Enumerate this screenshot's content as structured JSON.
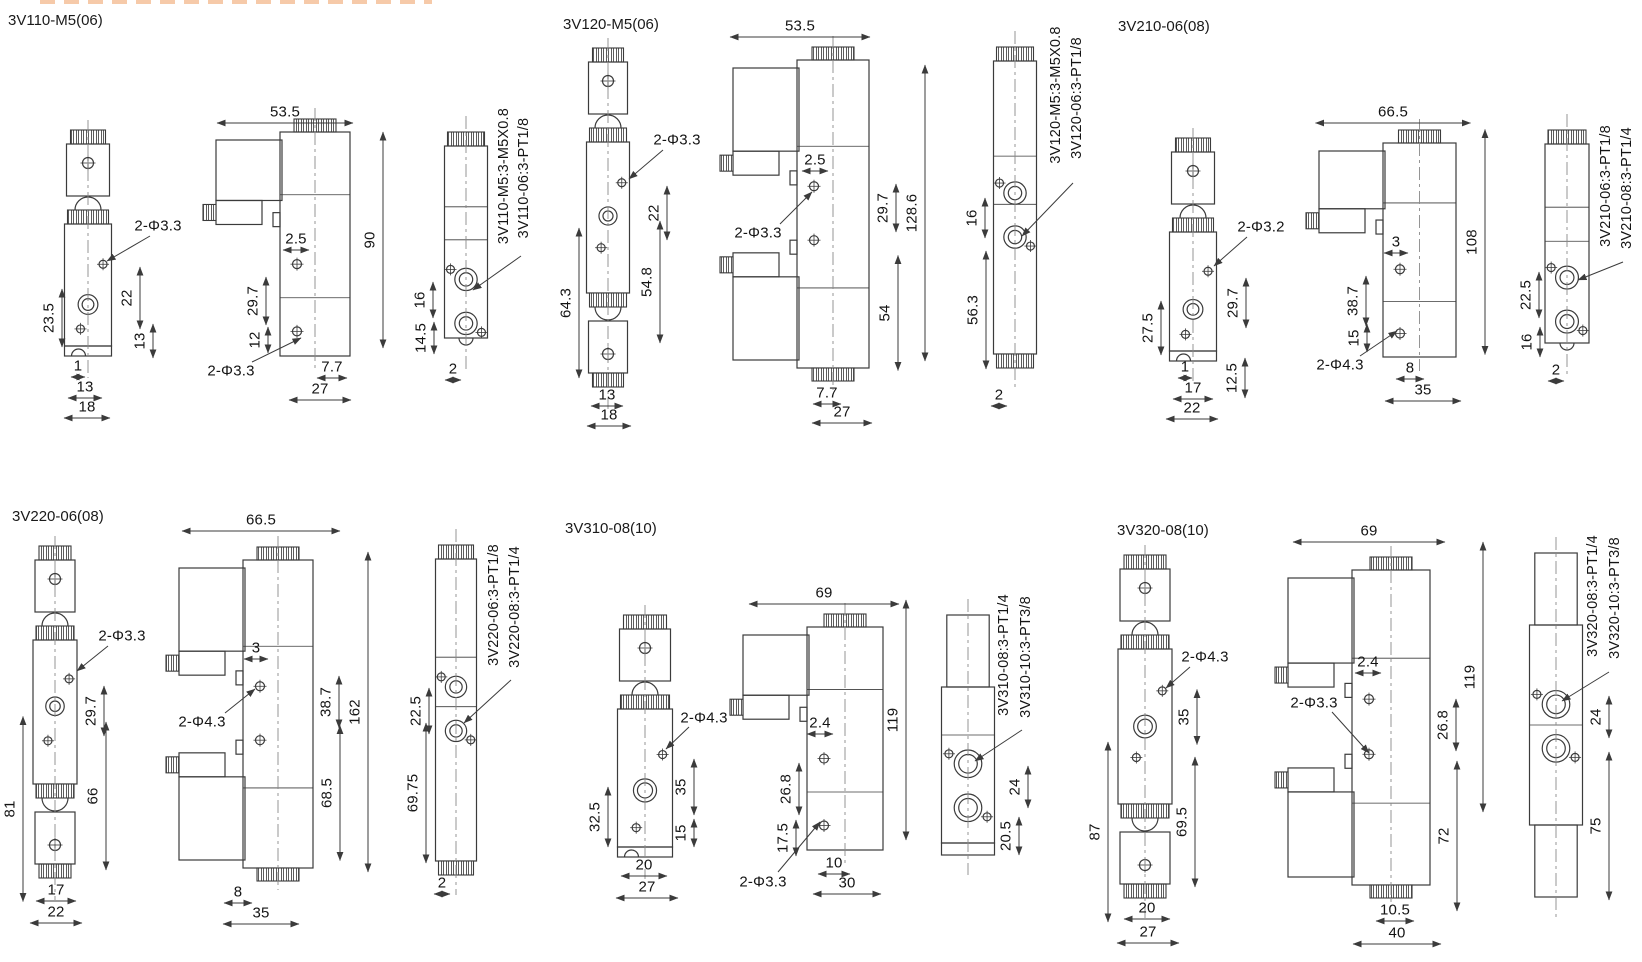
{
  "canvas": {
    "width": 1642,
    "height": 962,
    "background": "#ffffff",
    "line_color": "#3b3b3b",
    "text_color": "#141414"
  },
  "groups": [
    {
      "title": "3V110-M5(06)",
      "views": [
        {
          "kind": "front",
          "cx": 88,
          "top": 130,
          "bottom": 356,
          "bw": 47,
          "pf": 0.66
        },
        {
          "kind": "side",
          "x": 280,
          "top": 132,
          "bottom": 356,
          "bw": 70
        },
        {
          "kind": "end",
          "cx": 466,
          "top": 132,
          "bottom": 352,
          "bw": 43,
          "style": "knurl",
          "pf": 0.67
        }
      ],
      "labels": [
        {
          "t": "2-Φ3.3",
          "x": 158,
          "y": 226,
          "ls": [
            150,
            236
          ],
          "ldr": [
            107,
            261
          ]
        },
        {
          "t": "22",
          "x": 127,
          "y": 298,
          "r": 1,
          "span": 62
        },
        {
          "t": "13",
          "x": 140,
          "y": 341,
          "r": 1,
          "span": 34
        },
        {
          "t": "23.5",
          "x": 49,
          "y": 318,
          "r": 1,
          "span": 58
        },
        {
          "t": "1",
          "x": 78,
          "y": 366,
          "span": 14
        },
        {
          "t": "13",
          "x": 85,
          "y": 387,
          "span": 34
        },
        {
          "t": "18",
          "x": 87,
          "y": 407,
          "span": 46
        },
        {
          "t": "53.5",
          "x": 285,
          "y": 112,
          "span": 136
        },
        {
          "t": "90",
          "x": 370,
          "y": 240,
          "r": 1,
          "span": 216
        },
        {
          "t": "2.5",
          "x": 296,
          "y": 239,
          "span": 26
        },
        {
          "t": "29.7",
          "x": 253,
          "y": 301,
          "r": 1,
          "span": 48
        },
        {
          "t": "12",
          "x": 255,
          "y": 340,
          "r": 1,
          "span": 26
        },
        {
          "t": "2-Φ3.3",
          "x": 231,
          "y": 371,
          "ls": [
            252,
            362
          ],
          "ldr": [
            301,
            338
          ]
        },
        {
          "t": "7.7",
          "x": 332,
          "y": 367,
          "span": 30
        },
        {
          "t": "27",
          "x": 320,
          "y": 389,
          "span": 62
        },
        {
          "t": "3V110-M5:3-M5X0.8",
          "x": 504,
          "y": 176,
          "r": 1,
          "part": 1
        },
        {
          "t": "3V110-06:3-PT1/8",
          "x": 524,
          "y": 178,
          "r": 1,
          "part": 1,
          "ls": [
            521,
            256
          ],
          "ldr": [
            473,
            290
          ]
        },
        {
          "t": "16",
          "x": 420,
          "y": 300,
          "r": 1,
          "span": 36
        },
        {
          "t": "14.5",
          "x": 421,
          "y": 338,
          "r": 1,
          "span": 32
        },
        {
          "t": "2",
          "x": 453,
          "y": 369,
          "span": 16
        }
      ]
    },
    {
      "title": "3V120-M5(06)",
      "views": [
        {
          "kind": "front",
          "cx": 608,
          "top": 48,
          "bottom": 387,
          "bw": 43,
          "double": 1,
          "pf": 0.49
        },
        {
          "kind": "side",
          "x": 797,
          "top": 60,
          "bottom": 368,
          "bw": 72,
          "double": 1
        },
        {
          "kind": "end",
          "cx": 1015,
          "top": 47,
          "bottom": 368,
          "bw": 43,
          "style": "knurl",
          "double": 1,
          "pf": 0.455
        }
      ],
      "labels": [
        {
          "t": "2-Φ3.3",
          "x": 677,
          "y": 140,
          "ls": [
            663,
            150
          ],
          "ldr": [
            629,
            179
          ]
        },
        {
          "t": "22",
          "x": 654,
          "y": 213,
          "r": 1,
          "span": 54
        },
        {
          "t": "64.3",
          "x": 566,
          "y": 303,
          "r": 1,
          "span": 150
        },
        {
          "t": "54.8",
          "x": 647,
          "y": 282,
          "r": 1,
          "span": 122
        },
        {
          "t": "13",
          "x": 607,
          "y": 395,
          "span": 32
        },
        {
          "t": "18",
          "x": 609,
          "y": 415,
          "span": 44
        },
        {
          "t": "53.5",
          "x": 800,
          "y": 26,
          "span": 140
        },
        {
          "t": "2.5",
          "x": 815,
          "y": 160,
          "span": 26
        },
        {
          "t": "2-Φ3.3",
          "x": 758,
          "y": 233,
          "ls": [
            780,
            224
          ],
          "ldr": [
            812,
            192
          ]
        },
        {
          "t": "29.7",
          "x": 883,
          "y": 208,
          "r": 1,
          "span": 48
        },
        {
          "t": "128.6",
          "x": 912,
          "y": 213,
          "r": 1,
          "span": 296
        },
        {
          "t": "54",
          "x": 885,
          "y": 313,
          "r": 1,
          "span": 115
        },
        {
          "t": "7.7",
          "x": 827,
          "y": 393,
          "span": 28
        },
        {
          "t": "27",
          "x": 842,
          "y": 412,
          "span": 60
        },
        {
          "t": "16",
          "x": 972,
          "y": 218,
          "r": 1,
          "span": 40
        },
        {
          "t": "56.3",
          "x": 973,
          "y": 310,
          "r": 1,
          "span": 118
        },
        {
          "t": "2",
          "x": 999,
          "y": 395,
          "span": 16
        },
        {
          "t": "3V120-M5:3-M5X0.8",
          "x": 1056,
          "y": 95,
          "r": 1,
          "part": 1
        },
        {
          "t": "3V120-06:3-PT1/8",
          "x": 1077,
          "y": 98,
          "r": 1,
          "part": 1,
          "ls": [
            1073,
            183
          ],
          "ldr": [
            1022,
            236
          ]
        }
      ]
    },
    {
      "title": "3V210-06(08)",
      "views": [
        {
          "kind": "front",
          "cx": 1193,
          "top": 138,
          "bottom": 361,
          "bw": 47,
          "pf": 0.65
        },
        {
          "kind": "side",
          "x": 1383,
          "top": 143,
          "bottom": 357,
          "bw": 73
        },
        {
          "kind": "end",
          "cx": 1567,
          "top": 130,
          "bottom": 357,
          "bw": 44,
          "style": "knurl",
          "pf": 0.65
        }
      ],
      "labels": [
        {
          "t": "2-Φ3.2",
          "x": 1261,
          "y": 227,
          "ls": [
            1247,
            237
          ],
          "ldr": [
            1214,
            266
          ]
        },
        {
          "t": "29.7",
          "x": 1233,
          "y": 303,
          "r": 1,
          "span": 50
        },
        {
          "t": "12.5",
          "x": 1232,
          "y": 378,
          "r": 1,
          "span": 40
        },
        {
          "t": "27.5",
          "x": 1148,
          "y": 328,
          "r": 1,
          "span": 54
        },
        {
          "t": "1",
          "x": 1185,
          "y": 367,
          "span": 14
        },
        {
          "t": "17",
          "x": 1193,
          "y": 388,
          "span": 40
        },
        {
          "t": "22",
          "x": 1192,
          "y": 408,
          "span": 52
        },
        {
          "t": "66.5",
          "x": 1393,
          "y": 112,
          "span": 155
        },
        {
          "t": "108",
          "x": 1472,
          "y": 242,
          "r": 1,
          "span": 225
        },
        {
          "t": "3",
          "x": 1396,
          "y": 242,
          "span": 24
        },
        {
          "t": "38.7",
          "x": 1353,
          "y": 301,
          "r": 1,
          "span": 50
        },
        {
          "t": "15",
          "x": 1354,
          "y": 338,
          "r": 1,
          "span": 28
        },
        {
          "t": "2-Φ4.3",
          "x": 1340,
          "y": 365,
          "ls": [
            1360,
            356
          ],
          "ldr": [
            1397,
            331
          ]
        },
        {
          "t": "8",
          "x": 1410,
          "y": 368,
          "span": 28
        },
        {
          "t": "35",
          "x": 1423,
          "y": 390,
          "span": 76
        },
        {
          "t": "22.5",
          "x": 1526,
          "y": 295,
          "r": 1,
          "span": 46
        },
        {
          "t": "16",
          "x": 1527,
          "y": 342,
          "r": 1,
          "span": 30
        },
        {
          "t": "2",
          "x": 1556,
          "y": 370,
          "span": 16
        },
        {
          "t": "3V210-06:3-PT1/8",
          "x": 1606,
          "y": 186,
          "r": 1,
          "part": 1
        },
        {
          "t": "3V210-08:3-PT1/4",
          "x": 1627,
          "y": 188,
          "r": 1,
          "part": 1,
          "ls": [
            1623,
            262
          ],
          "ldr": [
            1578,
            280
          ]
        }
      ]
    },
    {
      "title": "3V220-06(08)",
      "views": [
        {
          "kind": "front",
          "cx": 55,
          "top": 546,
          "bottom": 878,
          "bw": 44,
          "double": 1,
          "pf": 0.46
        },
        {
          "kind": "side",
          "x": 243,
          "top": 560,
          "bottom": 868,
          "bw": 70,
          "double": 1
        },
        {
          "kind": "end",
          "cx": 456,
          "top": 545,
          "bottom": 875,
          "bw": 41,
          "style": "knurl",
          "double": 1,
          "pf": 0.43
        }
      ],
      "labels": [
        {
          "t": "2-Φ3.3",
          "x": 122,
          "y": 636,
          "ls": [
            108,
            646
          ],
          "ldr": [
            77,
            671
          ]
        },
        {
          "t": "29.7",
          "x": 91,
          "y": 711,
          "r": 1,
          "span": 50
        },
        {
          "t": "66",
          "x": 93,
          "y": 796,
          "r": 1,
          "span": 148
        },
        {
          "t": "81",
          "x": 10,
          "y": 809,
          "r": 1,
          "span": 185
        },
        {
          "t": "17",
          "x": 56,
          "y": 890,
          "span": 40
        },
        {
          "t": "22",
          "x": 56,
          "y": 912,
          "span": 52
        },
        {
          "t": "66.5",
          "x": 261,
          "y": 520,
          "span": 158
        },
        {
          "t": "3",
          "x": 256,
          "y": 648,
          "span": 24
        },
        {
          "t": "2-Φ4.3",
          "x": 202,
          "y": 722,
          "ls": [
            225,
            713
          ],
          "ldr": [
            255,
            689
          ]
        },
        {
          "t": "38.7",
          "x": 326,
          "y": 702,
          "r": 1,
          "span": 52
        },
        {
          "t": "68.5",
          "x": 327,
          "y": 793,
          "r": 1,
          "span": 135
        },
        {
          "t": "162",
          "x": 355,
          "y": 712,
          "r": 1,
          "span": 320
        },
        {
          "t": "8",
          "x": 238,
          "y": 892,
          "span": 28
        },
        {
          "t": "35",
          "x": 261,
          "y": 913,
          "span": 76
        },
        {
          "t": "22.5",
          "x": 416,
          "y": 711,
          "r": 1,
          "span": 46
        },
        {
          "t": "69.75",
          "x": 413,
          "y": 793,
          "r": 1,
          "span": 140
        },
        {
          "t": "2",
          "x": 442,
          "y": 883,
          "span": 16
        },
        {
          "t": "3V220-06:3-PT1/8",
          "x": 494,
          "y": 605,
          "r": 1,
          "part": 1
        },
        {
          "t": "3V220-08:3-PT1/4",
          "x": 515,
          "y": 607,
          "r": 1,
          "part": 1,
          "ls": [
            511,
            680
          ],
          "ldr": [
            464,
            723
          ]
        }
      ]
    },
    {
      "title": "3V310-08(10)",
      "views": [
        {
          "kind": "front",
          "cx": 645,
          "top": 615,
          "bottom": 857,
          "bw": 55,
          "pf": 0.59
        },
        {
          "kind": "side",
          "x": 807,
          "top": 627,
          "bottom": 850,
          "bw": 76
        },
        {
          "kind": "end",
          "cx": 968,
          "top": 615,
          "bottom": 855,
          "bw": 53,
          "style": "plain",
          "pf": 0.62
        }
      ],
      "labels": [
        {
          "t": "2-Φ4.3",
          "x": 704,
          "y": 718,
          "ls": [
            689,
            727
          ],
          "ldr": [
            666,
            749
          ]
        },
        {
          "t": "35",
          "x": 681,
          "y": 787,
          "r": 1,
          "span": 56
        },
        {
          "t": "15",
          "x": 681,
          "y": 833,
          "r": 1,
          "span": 28
        },
        {
          "t": "32.5",
          "x": 595,
          "y": 817,
          "r": 1,
          "span": 60
        },
        {
          "t": "20",
          "x": 644,
          "y": 865,
          "span": 46
        },
        {
          "t": "27",
          "x": 647,
          "y": 887,
          "span": 62
        },
        {
          "t": "69",
          "x": 824,
          "y": 593,
          "span": 150
        },
        {
          "t": "2.4",
          "x": 820,
          "y": 723,
          "span": 26
        },
        {
          "t": "26.8",
          "x": 786,
          "y": 789,
          "r": 1,
          "span": 52
        },
        {
          "t": "17.5",
          "x": 783,
          "y": 838,
          "r": 1,
          "span": 36
        },
        {
          "t": "119",
          "x": 893,
          "y": 720,
          "r": 1,
          "span": 240
        },
        {
          "t": "10",
          "x": 834,
          "y": 863,
          "span": 32
        },
        {
          "t": "30",
          "x": 847,
          "y": 883,
          "span": 68
        },
        {
          "t": "2-Φ3.3",
          "x": 763,
          "y": 882,
          "ls": [
            778,
            872
          ],
          "ldr": [
            820,
            822
          ]
        },
        {
          "t": "24",
          "x": 1015,
          "y": 787,
          "r": 1,
          "span": 42
        },
        {
          "t": "20.5",
          "x": 1006,
          "y": 836,
          "r": 1,
          "span": 38
        },
        {
          "t": "3V310-08:3-PT1/4",
          "x": 1004,
          "y": 655,
          "r": 1,
          "part": 1
        },
        {
          "t": "3V310-10:3-PT3/8",
          "x": 1026,
          "y": 657,
          "r": 1,
          "part": 1,
          "ls": [
            1022,
            730
          ],
          "ldr": [
            975,
            761
          ]
        }
      ]
    },
    {
      "title": "3V320-08(10)",
      "views": [
        {
          "kind": "front",
          "cx": 1145,
          "top": 555,
          "bottom": 898,
          "bw": 54,
          "double": 1,
          "pf": 0.5
        },
        {
          "kind": "side",
          "x": 1352,
          "top": 570,
          "bottom": 885,
          "bw": 78,
          "double": 1
        },
        {
          "kind": "end",
          "cx": 1556,
          "top": 553,
          "bottom": 897,
          "bw": 53,
          "style": "plain",
          "double": 1,
          "pf": 0.44
        }
      ],
      "labels": [
        {
          "t": "2-Φ4.3",
          "x": 1205,
          "y": 657,
          "ls": [
            1190,
            667
          ],
          "ldr": [
            1166,
            688
          ]
        },
        {
          "t": "35",
          "x": 1184,
          "y": 717,
          "r": 1,
          "span": 55
        },
        {
          "t": "69.5",
          "x": 1182,
          "y": 822,
          "r": 1,
          "span": 130
        },
        {
          "t": "87",
          "x": 1095,
          "y": 832,
          "r": 1,
          "span": 180
        },
        {
          "t": "20",
          "x": 1147,
          "y": 908,
          "span": 46
        },
        {
          "t": "27",
          "x": 1148,
          "y": 932,
          "span": 62
        },
        {
          "t": "69",
          "x": 1369,
          "y": 531,
          "span": 152
        },
        {
          "t": "2.4",
          "x": 1368,
          "y": 662,
          "span": 26
        },
        {
          "t": "2-Φ3.3",
          "x": 1314,
          "y": 703,
          "ls": [
            1332,
            712
          ],
          "ldr": [
            1369,
            753
          ]
        },
        {
          "t": "26.8",
          "x": 1443,
          "y": 725,
          "r": 1,
          "span": 52
        },
        {
          "t": "72",
          "x": 1444,
          "y": 836,
          "r": 1,
          "span": 150
        },
        {
          "t": "119",
          "x": 1470,
          "y": 677,
          "r": 1,
          "span": 270
        },
        {
          "t": "10.5",
          "x": 1395,
          "y": 910,
          "span": 38
        },
        {
          "t": "40",
          "x": 1397,
          "y": 933,
          "span": 88
        },
        {
          "t": "24",
          "x": 1596,
          "y": 717,
          "r": 1,
          "span": 42
        },
        {
          "t": "75",
          "x": 1596,
          "y": 826,
          "r": 1,
          "span": 148
        },
        {
          "t": "3V320-08:3-PT1/4",
          "x": 1593,
          "y": 596,
          "r": 1,
          "part": 1
        },
        {
          "t": "3V320-10:3-PT3/8",
          "x": 1615,
          "y": 598,
          "r": 1,
          "part": 1,
          "ls": [
            1609,
            672
          ],
          "ldr": [
            1562,
            701
          ]
        }
      ]
    }
  ]
}
